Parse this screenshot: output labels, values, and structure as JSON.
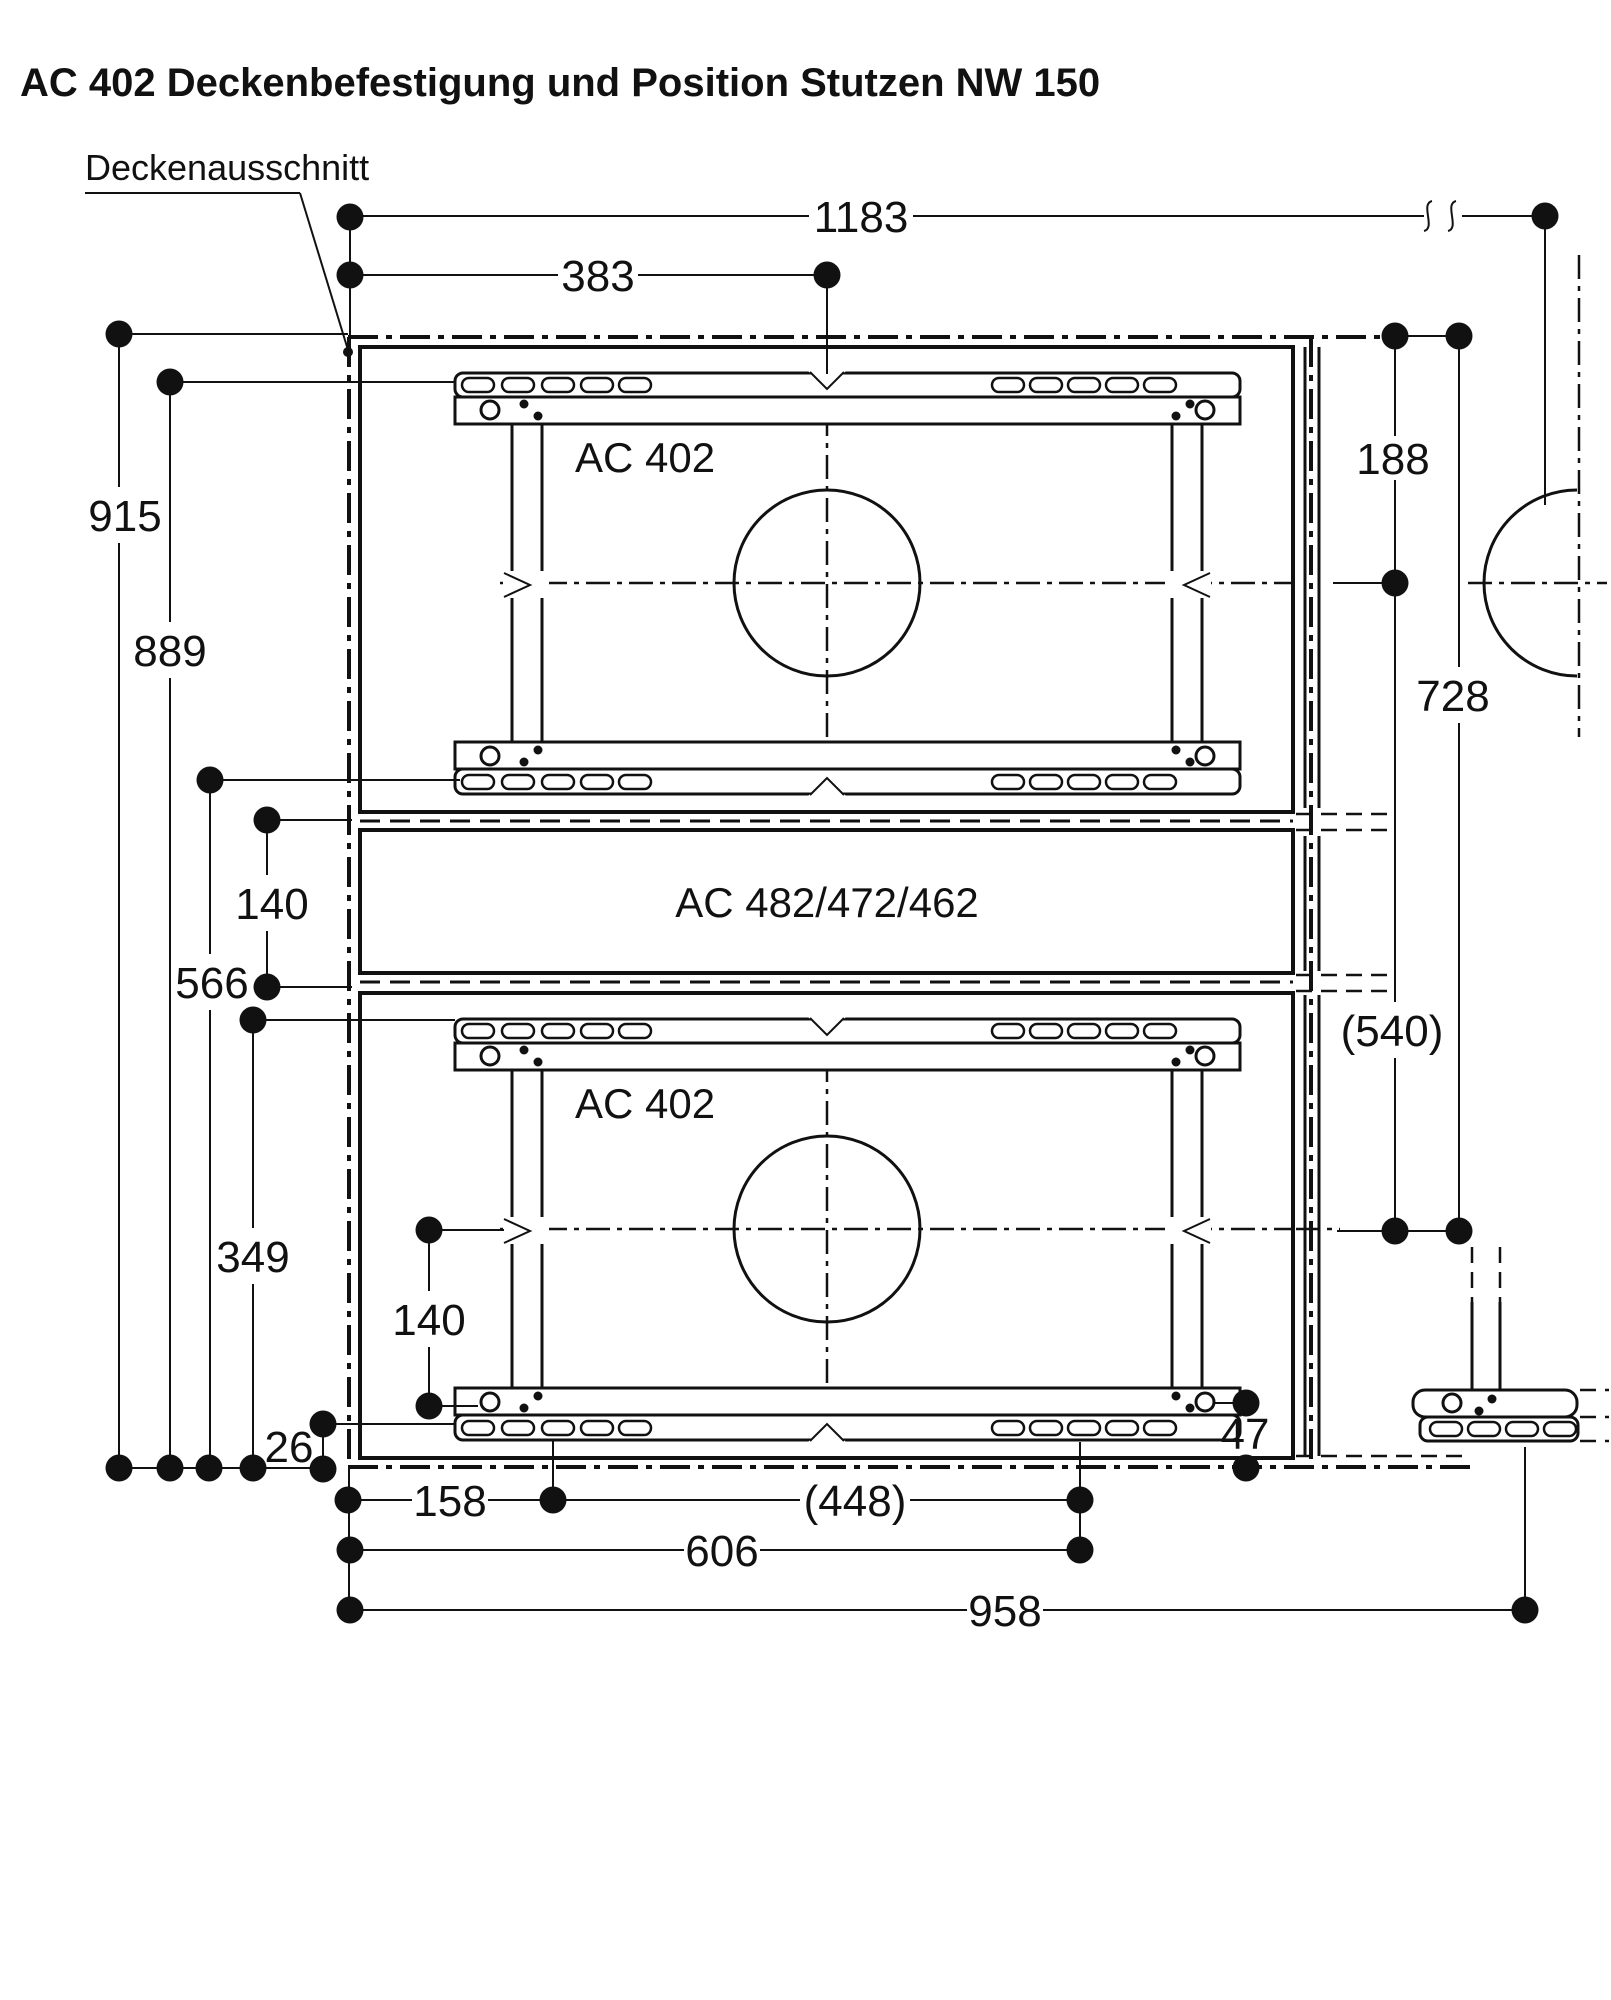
{
  "title": "AC 402 Deckenbefestigung und Position Stutzen NW 150",
  "labels": {
    "cutout": "Deckenausschnitt",
    "unit_top": "AC 402",
    "unit_middle": "AC 482/472/462",
    "unit_bottom": "AC 402"
  },
  "dims": {
    "d1183": "1183",
    "d383": "383",
    "d915": "915",
    "d889": "889",
    "d566": "566",
    "d140_upper": "140",
    "d349": "349",
    "d140_lower": "140",
    "d26": "26",
    "d158": "158",
    "d448": "(448)",
    "d606": "606",
    "d958": "958",
    "d188": "188",
    "d728": "728",
    "d540": "(540)",
    "d47": "47"
  },
  "colors": {
    "ink": "#111111",
    "background": "#ffffff"
  }
}
